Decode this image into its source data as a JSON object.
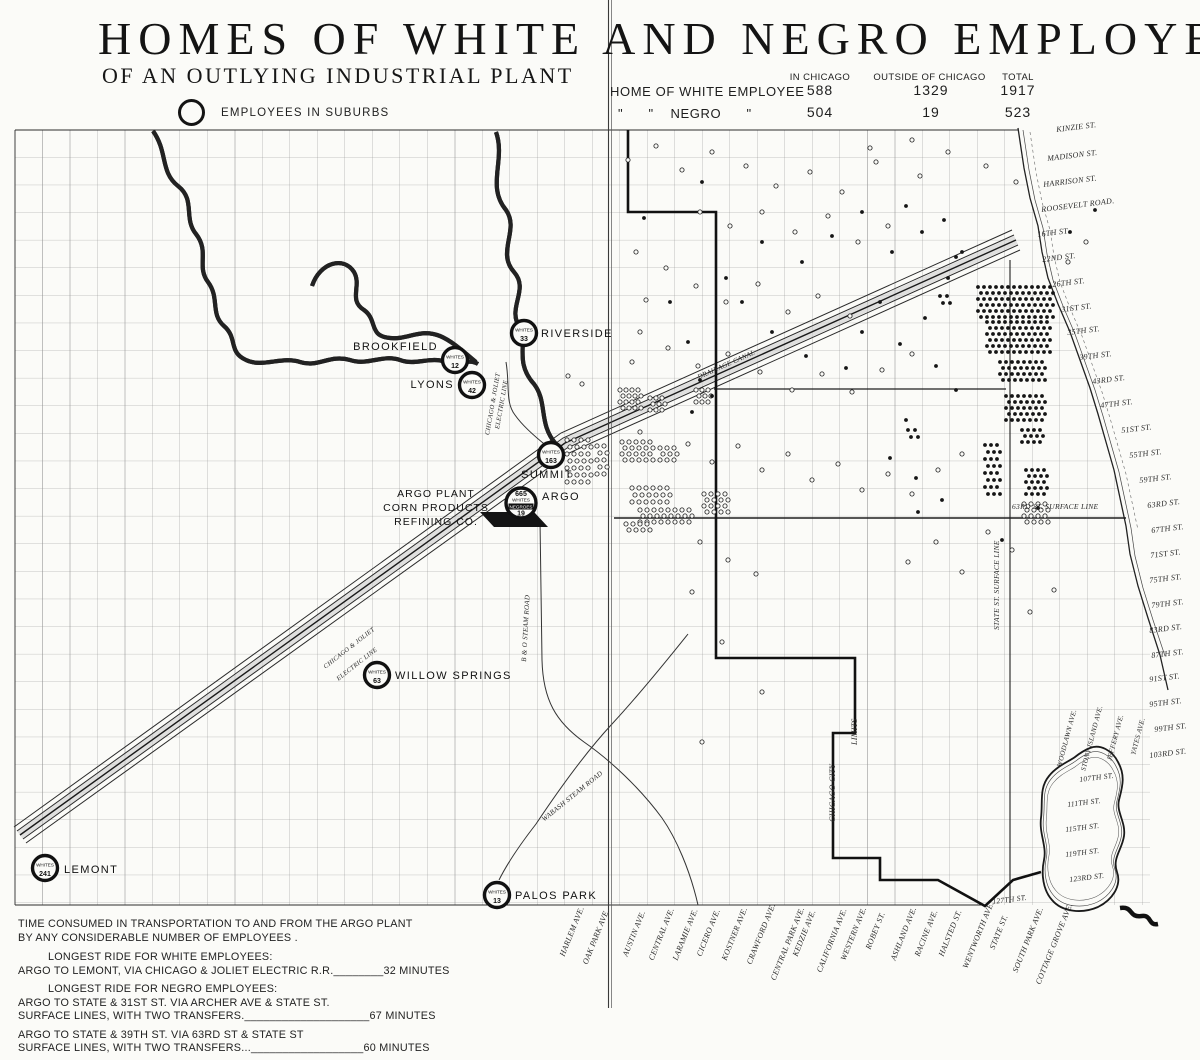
{
  "header": {
    "title": "HOMES OF WHITE AND NEGRO EMPLOYEES",
    "subtitle": "OF AN OUTLYING INDUSTRIAL PLANT",
    "legend_label": "EMPLOYEES IN SUBURBS"
  },
  "stats": {
    "columns": [
      "IN CHICAGO",
      "OUTSIDE OF CHICAGO",
      "TOTAL"
    ],
    "rows": [
      {
        "label": "HOME OF WHITE EMPLOYEE",
        "in_chicago": "588",
        "outside": "1329",
        "total": "1917"
      },
      {
        "label": "\"      \"    NEGRO      \"",
        "in_chicago": "504",
        "outside": "19",
        "total": "523"
      }
    ]
  },
  "map": {
    "suburbs": [
      {
        "name": "RIVERSIDE",
        "count_label": "WHITES",
        "count": "33",
        "cx": 524,
        "cy": 333,
        "label_x": 541,
        "label_y": 337,
        "anchor": "start"
      },
      {
        "name": "BROOKFIELD",
        "count_label": "WHITES",
        "count": "12",
        "cx": 455,
        "cy": 360,
        "label_x": 438,
        "label_y": 350,
        "anchor": "end"
      },
      {
        "name": "LYONS",
        "count_label": "WHITES",
        "count": "42",
        "cx": 472,
        "cy": 385,
        "label_x": 454,
        "label_y": 388,
        "anchor": "end"
      },
      {
        "name": "SUMMIT",
        "count_label": "WHITES",
        "count": "163",
        "cx": 551,
        "cy": 455,
        "label_x": 547,
        "label_y": 478,
        "anchor": "middle"
      },
      {
        "name": "WILLOW SPRINGS",
        "count_label": "WHITES",
        "count": "63",
        "cx": 377,
        "cy": 675,
        "label_x": 395,
        "label_y": 679,
        "anchor": "start"
      },
      {
        "name": "LEMONT",
        "count_label": "WHITES",
        "count": "241",
        "cx": 45,
        "cy": 868,
        "label_x": 64,
        "label_y": 873,
        "anchor": "start"
      },
      {
        "name": "PALOS PARK",
        "count_label": "WHITES",
        "count": "13",
        "cx": 497,
        "cy": 895,
        "label_x": 515,
        "label_y": 899,
        "anchor": "start"
      }
    ],
    "argo": {
      "name": "ARGO",
      "whites": "665",
      "whites_label": "WHITES",
      "negroes_label": "NEGROES",
      "negroes": "19",
      "cx": 521,
      "cy": 503,
      "label_x": 542,
      "label_y": 500
    },
    "plant_label": [
      "ARGO PLANT",
      "CORN PRODUCTS",
      "REFINING CO."
    ],
    "line_labels": [
      {
        "t": "CHICAGO & JOLIET",
        "x": 493,
        "y": 436,
        "r": -80,
        "s": 6.5
      },
      {
        "t": "ELECTRIC LINE",
        "x": 503,
        "y": 430,
        "r": -80,
        "s": 6.5
      },
      {
        "t": "CHICAGO & JOLIET",
        "x": 328,
        "y": 672,
        "r": -38,
        "s": 6.5
      },
      {
        "t": "ELECTRIC LINE",
        "x": 341,
        "y": 684,
        "r": -38,
        "s": 6.5
      },
      {
        "t": "B & O STEAM ROAD",
        "x": 529,
        "y": 662,
        "r": -87,
        "s": 7
      },
      {
        "t": "WABASH STEAM ROAD",
        "x": 546,
        "y": 824,
        "r": -39,
        "s": 7
      },
      {
        "t": "DRAINAGE CANAL",
        "x": 700,
        "y": 382,
        "r": -24,
        "s": 7
      },
      {
        "t": "63RD ST. SURFACE LINE",
        "x": 1012,
        "y": 512,
        "r": 0,
        "s": 7.5
      },
      {
        "t": "STATE ST. SURFACE LINE",
        "x": 1002,
        "y": 630,
        "r": -90,
        "s": 7.5
      },
      {
        "t": "CHICAGO CITY",
        "x": 838,
        "y": 822,
        "r": -90,
        "s": 8
      },
      {
        "t": "LIMITS",
        "x": 860,
        "y": 745,
        "r": -90,
        "s": 8
      }
    ],
    "streets_right": [
      {
        "t": "KINZIE ST.",
        "x": 1057,
        "y": 131
      },
      {
        "t": "MADISON ST.",
        "x": 1048,
        "y": 160
      },
      {
        "t": "HARRISON ST.",
        "x": 1044,
        "y": 186
      },
      {
        "t": "ROOSEVELT ROAD.",
        "x": 1042,
        "y": 211
      },
      {
        "t": "16TH ST.",
        "x": 1038,
        "y": 236
      },
      {
        "t": "22ND ST.",
        "x": 1043,
        "y": 261
      },
      {
        "t": "26TH ST.",
        "x": 1053,
        "y": 286
      },
      {
        "t": "31ST ST.",
        "x": 1062,
        "y": 311
      },
      {
        "t": "35TH ST.",
        "x": 1068,
        "y": 334
      },
      {
        "t": "39TH ST.",
        "x": 1080,
        "y": 359
      },
      {
        "t": "43RD ST.",
        "x": 1093,
        "y": 383
      },
      {
        "t": "47TH ST.",
        "x": 1101,
        "y": 407
      },
      {
        "t": "51ST ST.",
        "x": 1122,
        "y": 432
      },
      {
        "t": "55TH ST.",
        "x": 1130,
        "y": 457
      },
      {
        "t": "59TH ST.",
        "x": 1140,
        "y": 482
      },
      {
        "t": "63RD ST.",
        "x": 1148,
        "y": 507
      },
      {
        "t": "67TH ST.",
        "x": 1152,
        "y": 532
      },
      {
        "t": "71ST ST.",
        "x": 1151,
        "y": 557
      },
      {
        "t": "75TH ST.",
        "x": 1150,
        "y": 582
      },
      {
        "t": "79TH ST.",
        "x": 1152,
        "y": 607
      },
      {
        "t": "83RD ST.",
        "x": 1150,
        "y": 632
      },
      {
        "t": "87TH ST.",
        "x": 1152,
        "y": 657
      },
      {
        "t": "91ST ST.",
        "x": 1150,
        "y": 681
      },
      {
        "t": "95TH ST.",
        "x": 1150,
        "y": 706
      },
      {
        "t": "99TH ST.",
        "x": 1155,
        "y": 731
      },
      {
        "t": "103RD ST.",
        "x": 1150,
        "y": 757
      }
    ],
    "streets_lake": [
      {
        "t": "107TH ST.",
        "x": 1080,
        "y": 781
      },
      {
        "t": "111TH ST.",
        "x": 1068,
        "y": 806
      },
      {
        "t": "115TH ST.",
        "x": 1066,
        "y": 831
      },
      {
        "t": "119TH ST.",
        "x": 1066,
        "y": 856
      },
      {
        "t": "123RD ST.",
        "x": 1070,
        "y": 881
      },
      {
        "t": "127TH ST.",
        "x": 993,
        "y": 903
      }
    ],
    "avenues_lake": [
      {
        "t": "WOODLAWN AVE.",
        "x": 1064,
        "base": 768
      },
      {
        "t": "STONY ISLAND AVE.",
        "x": 1088,
        "base": 772
      },
      {
        "t": "JEFFERY AVE.",
        "x": 1114,
        "base": 762
      },
      {
        "t": "YATES AVE.",
        "x": 1138,
        "base": 756
      }
    ],
    "streets_bottom": [
      {
        "t": "HARLEM AVE.",
        "x": 567
      },
      {
        "t": "OAK PARK AVE.",
        "x": 590
      },
      {
        "t": "AUSTIN AVE.",
        "x": 630
      },
      {
        "t": "CENTRAL AVE.",
        "x": 656
      },
      {
        "t": "LARAMIE AVE.",
        "x": 680
      },
      {
        "t": "CICERO AVE.",
        "x": 704
      },
      {
        "t": "KOSTNER AVE.",
        "x": 729
      },
      {
        "t": "CRAWFORD AVE.",
        "x": 754
      },
      {
        "t": "CENTRAL PARK AVE.",
        "x": 778
      },
      {
        "t": "KEDZIE AVE.",
        "x": 800
      },
      {
        "t": "CALIFORNIA AVE.",
        "x": 824
      },
      {
        "t": "WESTERN AVE.",
        "x": 848
      },
      {
        "t": "ROBEY ST.",
        "x": 873
      },
      {
        "t": "ASHLAND AVE.",
        "x": 898
      },
      {
        "t": "RACINE AVE.",
        "x": 922
      },
      {
        "t": "HALSTED ST.",
        "x": 946
      },
      {
        "t": "WENTWORTH AVE.",
        "x": 970
      },
      {
        "t": "STATE ST.",
        "x": 997
      },
      {
        "t": "SOUTH PARK AVE.",
        "x": 1020
      },
      {
        "t": "COTTAGE GROVE AVE.",
        "x": 1043
      }
    ],
    "dots": {
      "filled_clusters": [
        [
          978,
          287,
          13,
          6,
          6,
          6
        ],
        [
          987,
          322,
          11,
          6,
          6,
          6
        ],
        [
          1000,
          362,
          8,
          4,
          6,
          6
        ],
        [
          1006,
          396,
          7,
          5,
          6,
          6
        ],
        [
          1022,
          430,
          4,
          3,
          6,
          6
        ],
        [
          985,
          445,
          3,
          8,
          6,
          7
        ],
        [
          1026,
          470,
          4,
          5,
          6,
          6
        ],
        [
          940,
          296,
          2,
          2,
          7,
          7
        ],
        [
          908,
          430,
          2,
          2,
          7,
          7
        ]
      ],
      "filled_singles": [
        [
          948,
          278
        ],
        [
          962,
          252
        ],
        [
          925,
          318
        ],
        [
          900,
          344
        ],
        [
          936,
          366
        ],
        [
          956,
          390
        ],
        [
          906,
          420
        ],
        [
          890,
          458
        ],
        [
          916,
          478
        ],
        [
          942,
          500
        ],
        [
          880,
          302
        ],
        [
          862,
          332
        ],
        [
          846,
          368
        ],
        [
          700,
          380
        ],
        [
          712,
          396
        ],
        [
          692,
          412
        ],
        [
          670,
          302
        ],
        [
          644,
          218
        ],
        [
          702,
          182
        ],
        [
          762,
          242
        ],
        [
          802,
          262
        ],
        [
          832,
          236
        ],
        [
          862,
          212
        ],
        [
          892,
          252
        ],
        [
          922,
          232
        ],
        [
          956,
          257
        ],
        [
          742,
          302
        ],
        [
          772,
          332
        ],
        [
          806,
          356
        ],
        [
          906,
          206
        ],
        [
          944,
          220
        ],
        [
          1070,
          232
        ],
        [
          1095,
          210
        ],
        [
          726,
          278
        ],
        [
          688,
          342
        ],
        [
          1038,
          508
        ],
        [
          1002,
          540
        ],
        [
          918,
          512
        ]
      ],
      "open_clusters": [
        [
          620,
          390,
          4,
          4,
          6,
          6
        ],
        [
          650,
          398,
          3,
          3,
          6,
          6
        ],
        [
          567,
          440,
          4,
          7,
          7,
          7
        ],
        [
          597,
          446,
          2,
          5,
          7,
          7
        ],
        [
          622,
          442,
          5,
          4,
          7,
          6
        ],
        [
          632,
          488,
          6,
          3,
          7,
          7
        ],
        [
          640,
          510,
          8,
          3,
          7,
          6
        ],
        [
          704,
          494,
          4,
          4,
          7,
          6
        ],
        [
          626,
          524,
          4,
          2,
          7,
          6
        ],
        [
          1024,
          504,
          4,
          4,
          7,
          6
        ],
        [
          696,
          390,
          3,
          3,
          6,
          6
        ],
        [
          660,
          448,
          3,
          3,
          7,
          6
        ]
      ],
      "open_singles": [
        [
          628,
          160
        ],
        [
          656,
          146
        ],
        [
          682,
          170
        ],
        [
          712,
          152
        ],
        [
          746,
          166
        ],
        [
          776,
          186
        ],
        [
          810,
          172
        ],
        [
          842,
          192
        ],
        [
          876,
          162
        ],
        [
          920,
          176
        ],
        [
          700,
          212
        ],
        [
          730,
          226
        ],
        [
          762,
          212
        ],
        [
          795,
          232
        ],
        [
          828,
          216
        ],
        [
          858,
          242
        ],
        [
          888,
          226
        ],
        [
          636,
          252
        ],
        [
          666,
          268
        ],
        [
          696,
          286
        ],
        [
          726,
          302
        ],
        [
          758,
          284
        ],
        [
          788,
          312
        ],
        [
          818,
          296
        ],
        [
          850,
          316
        ],
        [
          640,
          332
        ],
        [
          668,
          348
        ],
        [
          698,
          366
        ],
        [
          728,
          354
        ],
        [
          760,
          372
        ],
        [
          792,
          390
        ],
        [
          822,
          374
        ],
        [
          852,
          392
        ],
        [
          882,
          370
        ],
        [
          912,
          354
        ],
        [
          640,
          432
        ],
        [
          688,
          444
        ],
        [
          712,
          462
        ],
        [
          738,
          446
        ],
        [
          762,
          470
        ],
        [
          788,
          454
        ],
        [
          812,
          480
        ],
        [
          838,
          464
        ],
        [
          862,
          490
        ],
        [
          888,
          474
        ],
        [
          912,
          494
        ],
        [
          938,
          470
        ],
        [
          962,
          454
        ],
        [
          988,
          532
        ],
        [
          1012,
          550
        ],
        [
          962,
          572
        ],
        [
          936,
          542
        ],
        [
          908,
          562
        ],
        [
          700,
          542
        ],
        [
          728,
          560
        ],
        [
          756,
          574
        ],
        [
          692,
          592
        ],
        [
          722,
          642
        ],
        [
          762,
          692
        ],
        [
          702,
          742
        ],
        [
          1030,
          612
        ],
        [
          1054,
          590
        ],
        [
          568,
          376
        ],
        [
          582,
          384
        ],
        [
          632,
          362
        ],
        [
          1068,
          262
        ],
        [
          1086,
          242
        ],
        [
          912,
          140
        ],
        [
          948,
          152
        ],
        [
          986,
          166
        ],
        [
          1016,
          182
        ],
        [
          870,
          148
        ],
        [
          646,
          300
        ]
      ]
    }
  },
  "notes": {
    "lines": [
      {
        "t": "TIME CONSUMED IN TRANSPORTATION TO AND FROM THE ARGO PLANT",
        "ind": 0,
        "gap": 0
      },
      {
        "t": "BY ANY CONSIDERABLE NUMBER OF EMPLOYEES .",
        "ind": 0,
        "gap": 0
      },
      {
        "t": "LONGEST RIDE FOR WHITE EMPLOYEES:",
        "ind": 1,
        "gap": 6
      },
      {
        "t": "ARGO TO LEMONT, VIA CHICAGO & JOLIET ELECTRIC R.R.________32 MINUTES",
        "ind": 0,
        "gap": 0
      },
      {
        "t": "LONGEST RIDE FOR NEGRO EMPLOYEES:",
        "ind": 1,
        "gap": 5
      },
      {
        "t": "ARGO TO STATE & 31ST ST. VIA ARCHER AVE & STATE ST.",
        "ind": 0,
        "gap": 0
      },
      {
        "t": "SURFACE LINES, WITH TWO TRANSFERS.____________________67 MINUTES",
        "ind": 0,
        "gap": 0
      },
      {
        "t": "ARGO TO STATE & 39TH ST. VIA 63RD ST & STATE ST",
        "ind": 0,
        "gap": 5
      },
      {
        "t": "SURFACE LINES, WITH TWO TRANSFERS...__________________60 MINUTES",
        "ind": 0,
        "gap": 0
      }
    ]
  },
  "colors": {
    "ink": "#151515",
    "paper": "#fbfbf8",
    "grid": "#8f8f8f"
  }
}
